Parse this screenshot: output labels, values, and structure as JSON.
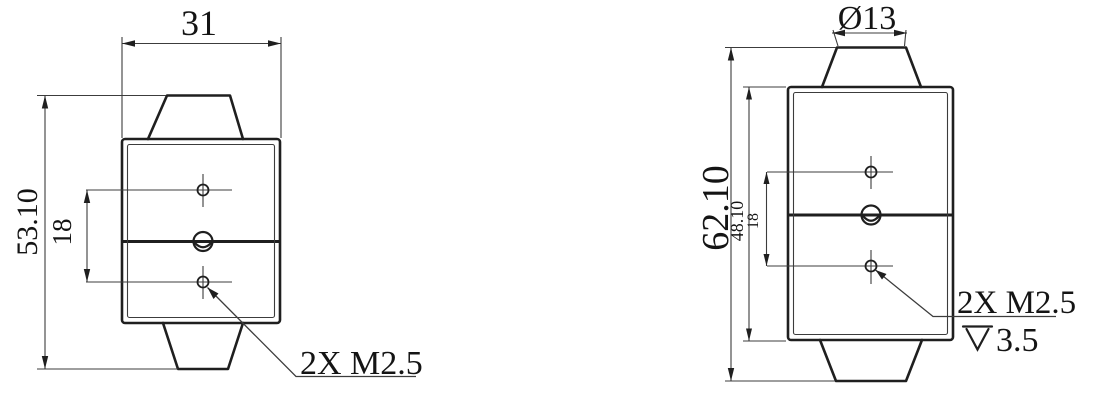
{
  "front_view": {
    "width_dim": "31",
    "overall_height_dim": "53.10",
    "hole_spacing_dim": "18",
    "thread_callout": "2X M2.5"
  },
  "side_view": {
    "boss_diameter_dim": "Ø13",
    "overall_height_dim": "62.10",
    "body_height_dim": "48.10",
    "hole_spacing_dim": "18",
    "thread_callout": "2X M2.5",
    "thread_depth_value": "3.5"
  },
  "colors": {
    "line": "#1f1f1f",
    "thin": "#3c3c3c",
    "background": "#ffffff",
    "text": "#141414"
  }
}
